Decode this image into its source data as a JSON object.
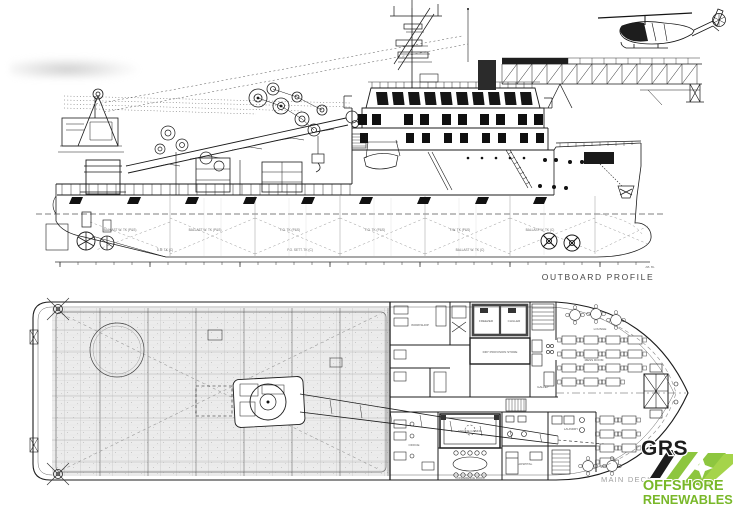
{
  "profile": {
    "caption": "OUTBOARD PROFILE",
    "baseline_note": "AB. BL",
    "tanks": [
      "BALLAST W. TK (P&S)",
      "BALLAST W. TK (P&S)",
      "F.O. TK (P&S)",
      "F.O. TK (P&S)",
      "F.W. TK (P&S)",
      "BALLAST W. TK (C)"
    ],
    "keel": [
      "D.B. TK (C)",
      "F.O. SETT. TK (C)",
      "BALLAST W. TK (C)"
    ]
  },
  "deck": {
    "caption": "MAIN DECK",
    "rooms": [
      "WORKSHOP",
      "FREEZER",
      "CHILLER",
      "DRY PROVISION STORE",
      "GALLEY",
      "LOUNGE",
      "MESS ROOM",
      "OFFICE",
      "ENGINE CASING",
      "CONFERENCE ROOM",
      "HOSPITAL",
      "LAUNDRY"
    ]
  },
  "logo": {
    "brand": "GRS",
    "line1": "OFFSHORE",
    "line2": "RENEWABLES",
    "colors": {
      "black": "#1c1c1c",
      "green": "#8dc63f",
      "green_light": "#a5d44a",
      "text_green": "#79b829"
    }
  }
}
